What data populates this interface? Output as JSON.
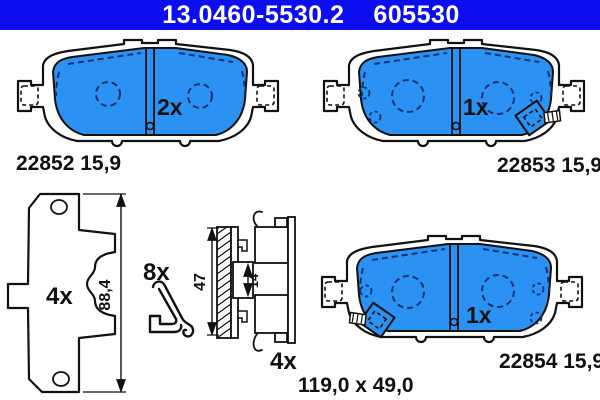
{
  "header": {
    "part_number": "13.0460-5530.2",
    "wva_number": "605530"
  },
  "pads": {
    "top_left": {
      "count": "2x",
      "label": "22852 15,9"
    },
    "top_right": {
      "count": "1x",
      "label": "22853 15,9"
    },
    "bottom_right": {
      "count": "1x",
      "label": "22854 15,9"
    }
  },
  "backplate_view": {
    "count": "4x",
    "height_dim": "88,4"
  },
  "spring_clip": {
    "count": "8x"
  },
  "section_view": {
    "count": "4x",
    "total_height": "47",
    "inner_height": "14"
  },
  "footer": {
    "pad_dimensions": "119,0 x 49,0"
  },
  "colors": {
    "header_bg": "#0d0df2",
    "header_text": "#ffffff",
    "pad_friction": "#2b91f2",
    "pad_marking": "#14306e",
    "line": "#111111"
  }
}
